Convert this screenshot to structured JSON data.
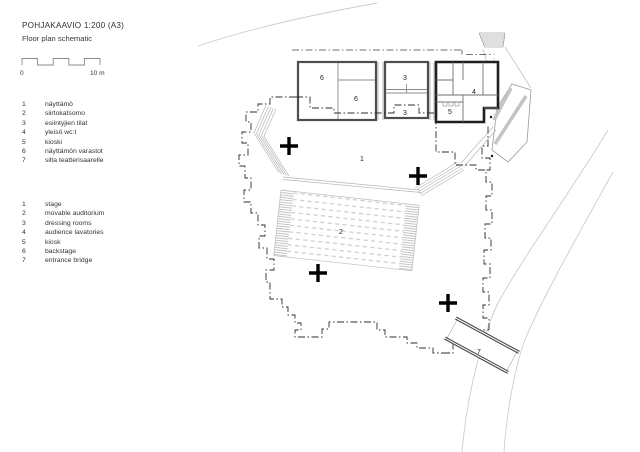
{
  "header": {
    "title": "POHJAKAAVIO 1:200 (A3)",
    "subtitle": "Floor plan schematic"
  },
  "scale_bar": {
    "zero_label": "0",
    "end_label": "10 m"
  },
  "legend_fi": [
    {
      "num": "1",
      "label": "näyttämö"
    },
    {
      "num": "2",
      "label": "siirtokatsomo"
    },
    {
      "num": "3",
      "label": "esiintyjien tilat"
    },
    {
      "num": "4",
      "label": "yleisö wc:t"
    },
    {
      "num": "5",
      "label": "kioski"
    },
    {
      "num": "6",
      "label": "näyttämön varastot"
    },
    {
      "num": "7",
      "label": "silta teatterisaarelle"
    }
  ],
  "legend_en": [
    {
      "num": "1",
      "label": "stage"
    },
    {
      "num": "2",
      "label": "movable auditorium"
    },
    {
      "num": "3",
      "label": "dressing rooms"
    },
    {
      "num": "4",
      "label": "audience lavatories"
    },
    {
      "num": "5",
      "label": "kiosk"
    },
    {
      "num": "6",
      "label": "backstage"
    },
    {
      "num": "7",
      "label": "entrance bridge"
    }
  ],
  "plan": {
    "room_labels": [
      {
        "num": "6",
        "meaning": "backstage"
      },
      {
        "num": "6",
        "meaning": "backstage"
      },
      {
        "num": "3",
        "meaning": "dressing rooms"
      },
      {
        "num": "3",
        "meaning": "dressing rooms"
      },
      {
        "num": "4",
        "meaning": "audience lavatories"
      },
      {
        "num": "5",
        "meaning": "kiosk"
      },
      {
        "num": "1",
        "meaning": "stage"
      },
      {
        "num": "2",
        "meaning": "movable auditorium"
      },
      {
        "num": "7",
        "meaning": "entrance bridge"
      }
    ],
    "colors": {
      "wall_gray": "#4d4d4d",
      "wall_black": "#1f1f1f",
      "interior_line": "#8c8c8c",
      "light_line": "#b5b5b5",
      "terrain_line": "#cdcdcd",
      "boundary_line": "#2e2e2e",
      "cross_marker": "#000000",
      "text": "#333333"
    }
  }
}
